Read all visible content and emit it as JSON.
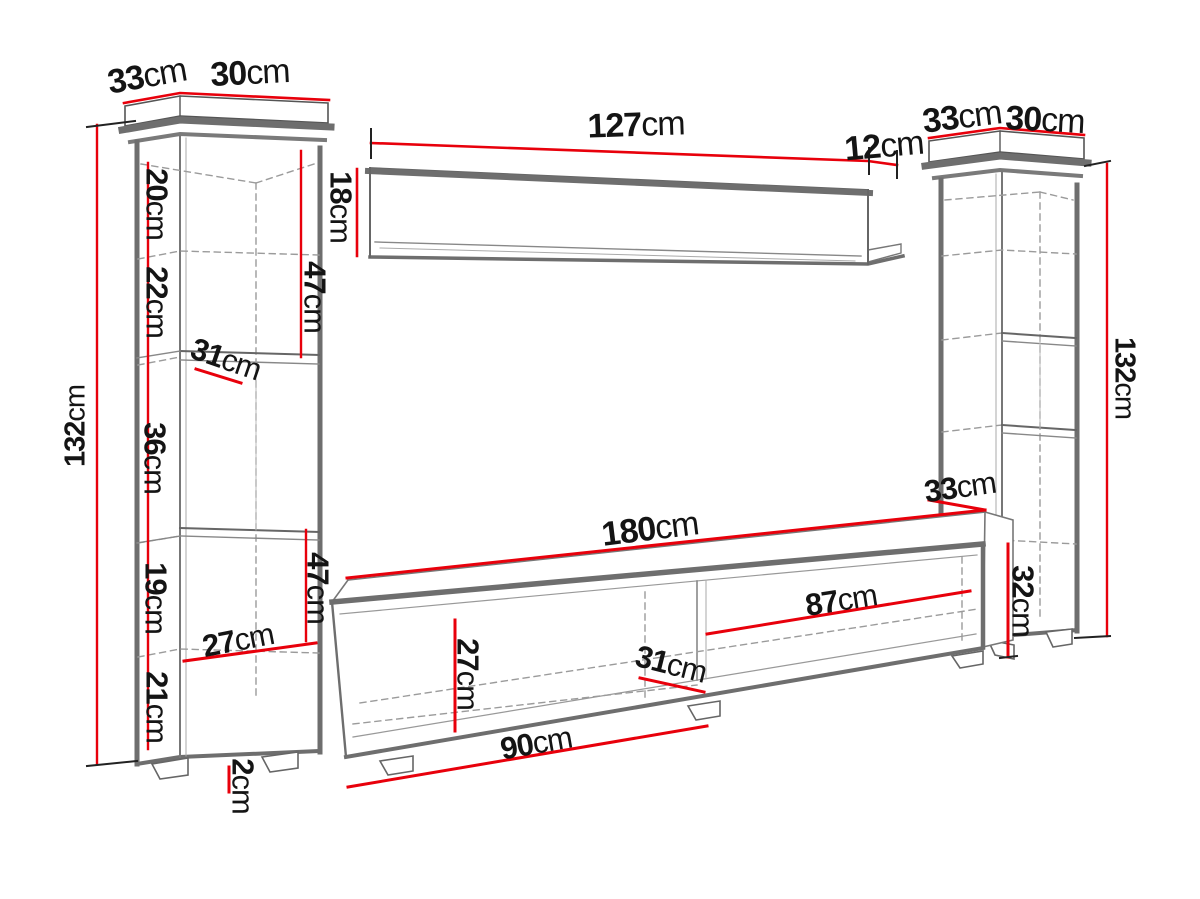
{
  "colors": {
    "accent_red": "#e8000b",
    "line_gray": "#6e6e6e",
    "dash_gray": "#9b9b9b",
    "text": "#141414",
    "background": "#ffffff"
  },
  "unit": "cm",
  "left_cabinet": {
    "depth": {
      "num": "33",
      "unit": "cm"
    },
    "width": {
      "num": "30",
      "unit": "cm"
    },
    "height": {
      "num": "132",
      "unit": "cm"
    },
    "sections": [
      {
        "num": "20",
        "unit": "cm"
      },
      {
        "num": "22",
        "unit": "cm"
      },
      {
        "num": "36",
        "unit": "cm"
      },
      {
        "num": "19",
        "unit": "cm"
      },
      {
        "num": "21",
        "unit": "cm"
      }
    ],
    "upper_shelf_depth": {
      "num": "31",
      "unit": "cm"
    },
    "lower_shelf_depth": {
      "num": "27",
      "unit": "cm"
    },
    "upper_front_height": {
      "num": "47",
      "unit": "cm"
    },
    "lower_front_height": {
      "num": "47",
      "unit": "cm"
    },
    "foot_height": {
      "num": "2",
      "unit": "cm"
    }
  },
  "wall_shelf": {
    "length": {
      "num": "127",
      "unit": "cm"
    },
    "end_depth": {
      "num": "12",
      "unit": "cm"
    },
    "height": {
      "num": "18",
      "unit": "cm"
    }
  },
  "right_cabinet": {
    "depth": {
      "num": "33",
      "unit": "cm"
    },
    "width": {
      "num": "30",
      "unit": "cm"
    },
    "height": {
      "num": "132",
      "unit": "cm"
    }
  },
  "tv_stand": {
    "length": {
      "num": "180",
      "unit": "cm"
    },
    "depth": {
      "num": "33",
      "unit": "cm"
    },
    "height": {
      "num": "32",
      "unit": "cm"
    },
    "right_compartment_width": {
      "num": "87",
      "unit": "cm"
    },
    "compartment_height": {
      "num": "27",
      "unit": "cm"
    },
    "compartment_depth": {
      "num": "31",
      "unit": "cm"
    },
    "left_compartment_width": {
      "num": "90",
      "unit": "cm"
    }
  }
}
